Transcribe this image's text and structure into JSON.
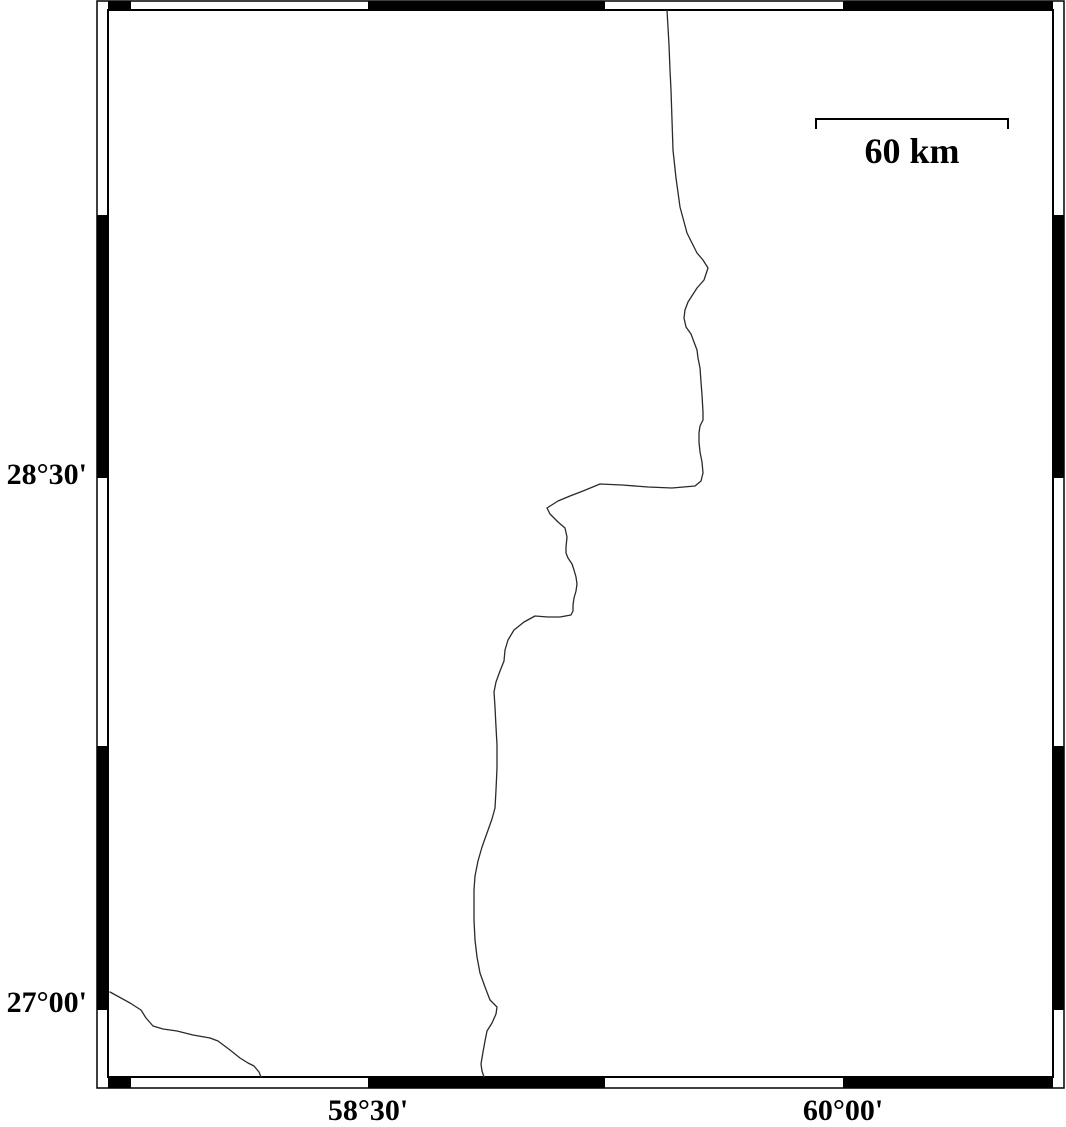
{
  "map": {
    "colors": {
      "frame": "#000000",
      "boundary_line": "#2a2a2a",
      "background": "#ffffff"
    },
    "projection_labels": {
      "latitude": [
        {
          "label": "28°30'",
          "x": 87,
          "y": 475,
          "align": "right"
        },
        {
          "label": "27°00'",
          "x": 87,
          "y": 1003,
          "align": "right"
        }
      ],
      "longitude": [
        {
          "label": "58°30'",
          "x": 368,
          "y": 1111,
          "align": "center"
        },
        {
          "label": "60°00'",
          "x": 843,
          "y": 1111,
          "align": "center"
        }
      ]
    },
    "scale_bar": {
      "label": "60 km",
      "x": 912,
      "y": 151,
      "align": "center",
      "bar": {
        "x1": 816,
        "x2": 1008,
        "y": 119,
        "tick_drop": 10,
        "stroke_width": 2
      }
    },
    "frame": {
      "outer": {
        "x1": 97,
        "y1": 1,
        "x2": 1064,
        "y2": 1088
      },
      "inner": {
        "x1": 108,
        "y1": 10,
        "x2": 1053,
        "y2": 1077
      },
      "top_ticks": [
        [
          108,
          131
        ],
        [
          368,
          605
        ],
        [
          843,
          1053
        ]
      ],
      "bottom_ticks": [
        [
          108,
          131
        ],
        [
          368,
          605
        ],
        [
          843,
          1053
        ]
      ],
      "left_ticks": [
        [
          215,
          478
        ],
        [
          746,
          1010
        ]
      ],
      "right_ticks": [
        [
          215,
          478
        ],
        [
          746,
          1010
        ]
      ]
    },
    "lines": {
      "main_boundary": [
        [
          667,
          10
        ],
        [
          669,
          45
        ],
        [
          670,
          70
        ],
        [
          671,
          90
        ],
        [
          672,
          120
        ],
        [
          673,
          150
        ],
        [
          676,
          178
        ],
        [
          680,
          207
        ],
        [
          687,
          233
        ],
        [
          697,
          253
        ],
        [
          703,
          260
        ],
        [
          708,
          268
        ],
        [
          704,
          280
        ],
        [
          697,
          288
        ],
        [
          688,
          302
        ],
        [
          685,
          310
        ],
        [
          684,
          318
        ],
        [
          686,
          327
        ],
        [
          691,
          334
        ],
        [
          694,
          342
        ],
        [
          697,
          350
        ],
        [
          698,
          358
        ],
        [
          700,
          368
        ],
        [
          701,
          382
        ],
        [
          702,
          395
        ],
        [
          703,
          412
        ],
        [
          703,
          420
        ],
        [
          700,
          426
        ],
        [
          699,
          433
        ],
        [
          699,
          442
        ],
        [
          700,
          452
        ],
        [
          702,
          462
        ],
        [
          703,
          473
        ],
        [
          701,
          481
        ],
        [
          695,
          486
        ],
        [
          672,
          488
        ],
        [
          648,
          487
        ],
        [
          622,
          485
        ],
        [
          600,
          484
        ],
        [
          583,
          491
        ],
        [
          570,
          496
        ],
        [
          558,
          501
        ],
        [
          547,
          508
        ],
        [
          550,
          514
        ],
        [
          558,
          522
        ],
        [
          565,
          528
        ],
        [
          567,
          537
        ],
        [
          566,
          547
        ],
        [
          566,
          553
        ],
        [
          568,
          558
        ],
        [
          572,
          564
        ],
        [
          574,
          570
        ],
        [
          576,
          577
        ],
        [
          577,
          584
        ],
        [
          576,
          591
        ],
        [
          574,
          598
        ],
        [
          573,
          605
        ],
        [
          573,
          611
        ],
        [
          571,
          615
        ],
        [
          560,
          617
        ],
        [
          548,
          617
        ],
        [
          535,
          616
        ],
        [
          524,
          622
        ],
        [
          514,
          630
        ],
        [
          508,
          640
        ],
        [
          505,
          650
        ],
        [
          504,
          661
        ],
        [
          500,
          671
        ],
        [
          496,
          682
        ],
        [
          494,
          692
        ],
        [
          495,
          707
        ],
        [
          496,
          727
        ],
        [
          497,
          745
        ],
        [
          497,
          768
        ],
        [
          496,
          790
        ],
        [
          495,
          808
        ],
        [
          492,
          819
        ],
        [
          487,
          833
        ],
        [
          482,
          847
        ],
        [
          478,
          861
        ],
        [
          475,
          876
        ],
        [
          474,
          890
        ],
        [
          474,
          905
        ],
        [
          474,
          920
        ],
        [
          475,
          940
        ],
        [
          477,
          957
        ],
        [
          480,
          973
        ],
        [
          485,
          987
        ],
        [
          490,
          1000
        ],
        [
          497,
          1007
        ],
        [
          496,
          1014
        ],
        [
          492,
          1023
        ],
        [
          487,
          1031
        ],
        [
          485,
          1041
        ],
        [
          483,
          1052
        ],
        [
          481,
          1064
        ],
        [
          482,
          1071
        ],
        [
          484,
          1077
        ]
      ],
      "southwest_boundary": [
        [
          110,
          992
        ],
        [
          130,
          1003
        ],
        [
          141,
          1010
        ],
        [
          146,
          1018
        ],
        [
          153,
          1026
        ],
        [
          163,
          1029
        ],
        [
          177,
          1031
        ],
        [
          193,
          1035
        ],
        [
          210,
          1038
        ],
        [
          218,
          1041
        ],
        [
          230,
          1050
        ],
        [
          240,
          1058
        ],
        [
          248,
          1063
        ],
        [
          254,
          1066
        ],
        [
          259,
          1072
        ],
        [
          261,
          1077
        ]
      ]
    }
  }
}
